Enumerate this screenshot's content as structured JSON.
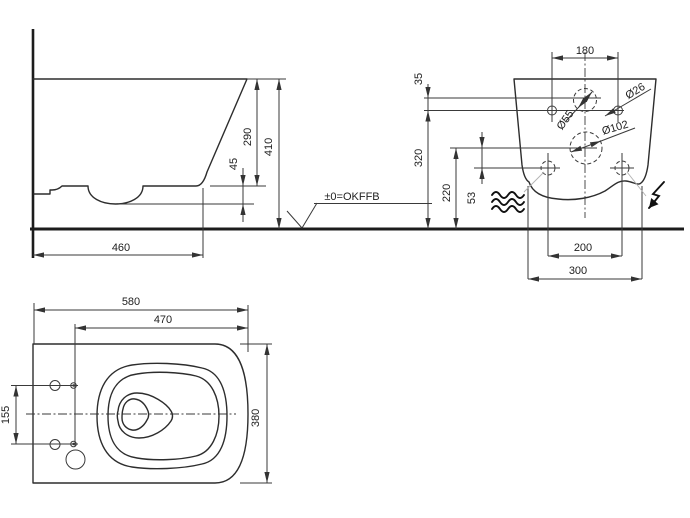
{
  "side_view": {
    "dim_depth": "460",
    "dim_rim_drop": "45",
    "dim_rim_height": "290",
    "dim_total_height": "410"
  },
  "datum": {
    "label": "±0=OKFFB"
  },
  "rear_view": {
    "dim_hole_spacing": "180",
    "dim_supply_offset": "35",
    "dim_fixing_height": "320",
    "dim_drain_height": "220",
    "dim_lower_offset": "53",
    "dim_lower_spacing": "200",
    "dim_outer_spacing": "300",
    "dia_supply": "Ø55",
    "dia_fixing": "Ø26",
    "dia_drain": "Ø102"
  },
  "top_view": {
    "dim_length": "580",
    "dim_seat_holes_to_front": "470",
    "dim_width": "380",
    "dim_seat_hole_spacing": "155"
  },
  "colors": {
    "line": "#333333",
    "background": "#ffffff",
    "leader": "#b3b3b3"
  }
}
